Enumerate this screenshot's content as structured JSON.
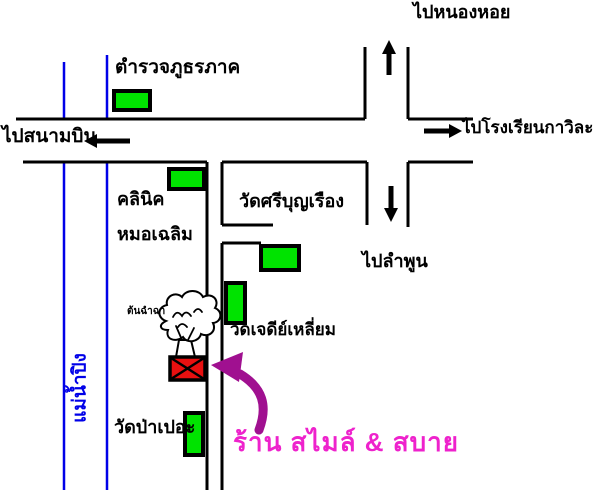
{
  "canvas": {
    "width": 600,
    "height": 490
  },
  "colors": {
    "road_black": "#000000",
    "river_blue": "#0000e8",
    "building_green": "#00e300",
    "destination_red": "#e81010",
    "shop_text_pink": "#ee22cc",
    "highlight_arrow_purple": "#a01090"
  },
  "labels": {
    "to_nong_hoi": "ไปหนองหอย",
    "police_station": "ตำรวจภูธรภาค",
    "to_airport": "ไปสนามบิน",
    "to_kawila_school": "ไปโรงเรียนกาวิละ",
    "clinic_line1": "คลินิค",
    "clinic_line2": "หมอเฉลิม",
    "wat_si_bunrueang": "วัดศรีบุญเรือง",
    "to_lamphun": "ไปลำพูน",
    "tree": "ต้นฉำฉา",
    "wat_chedi_liam": "วัดเจดีย์เหลี่ยม",
    "ping_river": "แม่น้ำปิง",
    "wat_pa_pao": "วัดป่าเปอะ",
    "shop_name": "ร้าน สไมล์ & สบาย"
  }
}
